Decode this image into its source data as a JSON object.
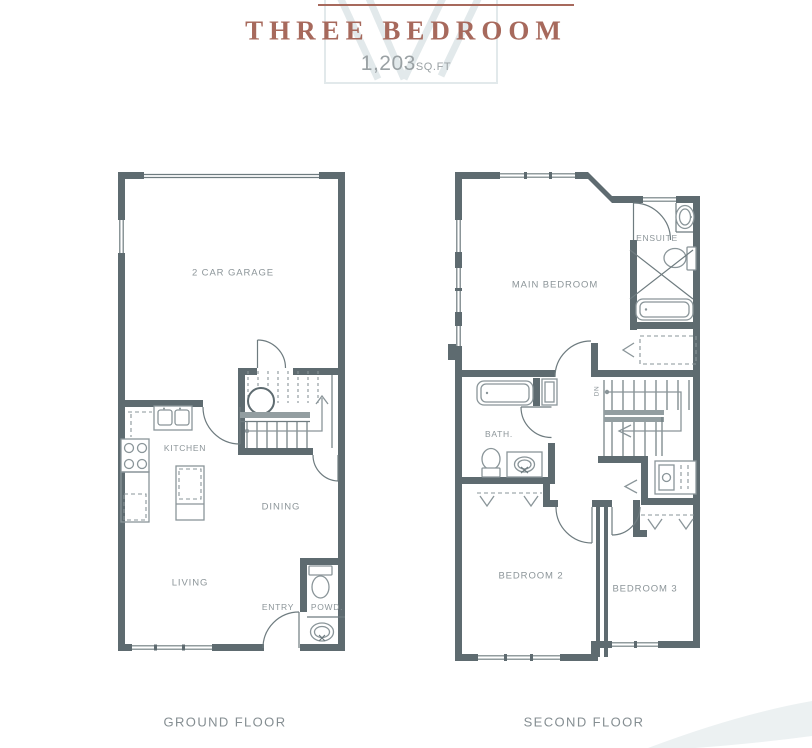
{
  "header": {
    "title": "THREE BEDROOM",
    "area_value": "1,203",
    "area_unit": "SQ.FT"
  },
  "plans": {
    "ground": {
      "caption": "GROUND FLOOR",
      "rooms": {
        "garage": "2 CAR GARAGE",
        "kitchen": "KITCHEN",
        "dining": "DINING",
        "living": "LIVING",
        "entry": "ENTRY",
        "powder": "POWD."
      }
    },
    "second": {
      "caption": "SECOND FLOOR",
      "rooms": {
        "main_bedroom": "MAIN BEDROOM",
        "ensuite": "ENSUITE",
        "bath": "BATH.",
        "bedroom2": "BEDROOM 2",
        "bedroom3": "BEDROOM 3",
        "stairs_down": "DN"
      }
    }
  },
  "colors": {
    "accent": "#a7695c",
    "wall": "#5e6b70",
    "thin": "#6e7b7f",
    "fixture": "#8a9599",
    "label": "#8c9599",
    "watermark": "#e2e9eb",
    "arc": "#ecf1f2",
    "area": "#9aa1a4"
  }
}
